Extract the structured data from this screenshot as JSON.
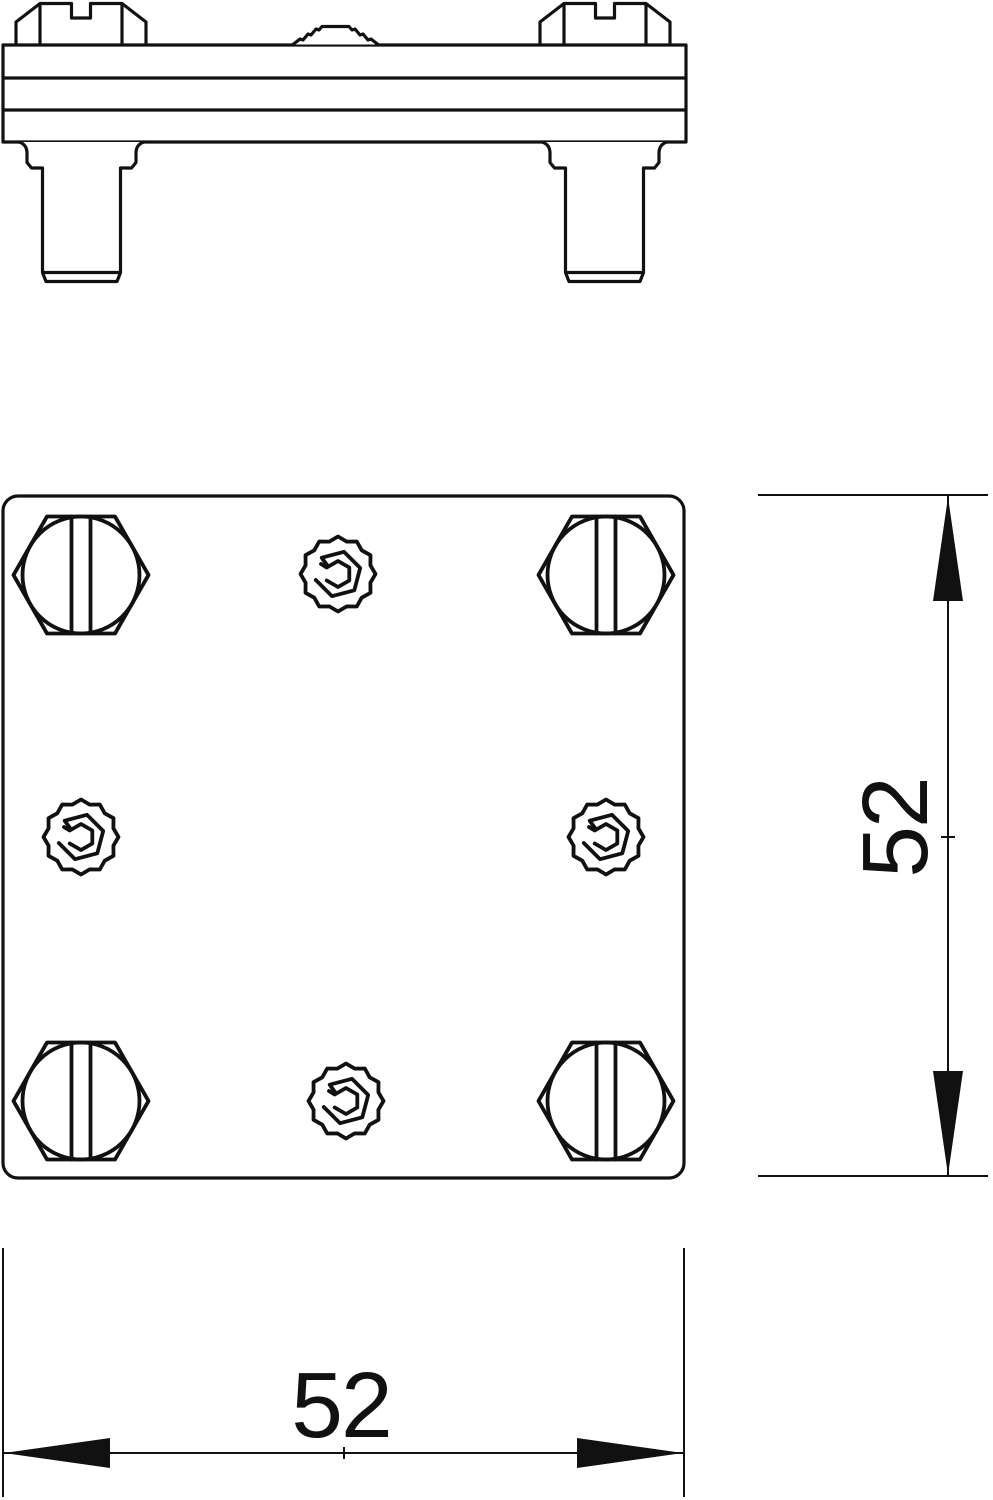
{
  "page": {
    "background": "#ffffff"
  },
  "drawing": {
    "ink_color": "#111111",
    "arrow_color": "#111111",
    "side_view": {
      "screw_count": 2,
      "stud_count": 2,
      "body_layer_lines": 3,
      "embossed_point_count": 1
    },
    "plan_view": {
      "hex_screw_count": 4,
      "contact_point_count": 4
    },
    "dimensions": {
      "height": {
        "value": "52"
      },
      "width": {
        "value": "52"
      }
    }
  }
}
